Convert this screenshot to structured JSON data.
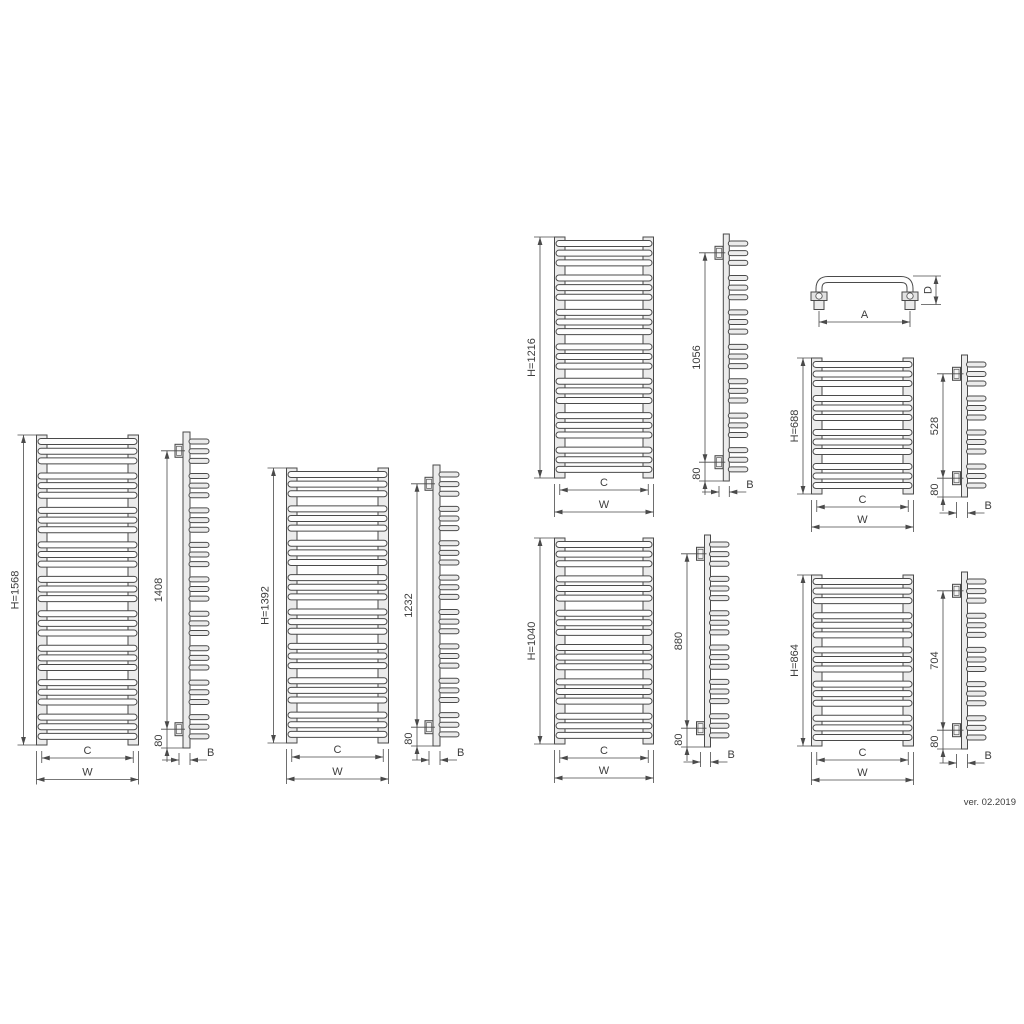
{
  "drawing": {
    "version_label": "ver. 02.2019",
    "handle_detail": {
      "width_label": "A",
      "depth_label": "D"
    },
    "radiators": [
      {
        "height_label": "H=1568",
        "bracket_span_label": "1408",
        "bottom_offset_label": "80",
        "center_dim_label": "C",
        "overall_width_label": "W",
        "depth_dim_label": "B",
        "tube_groups": 9,
        "tubes_per_group": 3
      },
      {
        "height_label": "H=1392",
        "bracket_span_label": "1232",
        "bottom_offset_label": "80",
        "center_dim_label": "C",
        "overall_width_label": "W",
        "depth_dim_label": "B",
        "tube_groups": 8,
        "tubes_per_group": 3
      },
      {
        "height_label": "H=1216",
        "bracket_span_label": "1056",
        "bottom_offset_label": "80",
        "center_dim_label": "C",
        "overall_width_label": "W",
        "depth_dim_label": "B",
        "tube_groups": 7,
        "tubes_per_group": 3
      },
      {
        "height_label": "H=1040",
        "bracket_span_label": "880",
        "bottom_offset_label": "80",
        "center_dim_label": "C",
        "overall_width_label": "W",
        "depth_dim_label": "B",
        "tube_groups": 6,
        "tubes_per_group": 3
      },
      {
        "height_label": "H=688",
        "bracket_span_label": "528",
        "bottom_offset_label": "80",
        "center_dim_label": "C",
        "overall_width_label": "W",
        "depth_dim_label": "B",
        "tube_groups": 4,
        "tubes_per_group": 3
      },
      {
        "height_label": "H=864",
        "bracket_span_label": "704",
        "bottom_offset_label": "80",
        "center_dim_label": "C",
        "overall_width_label": "W",
        "depth_dim_label": "B",
        "tube_groups": 5,
        "tubes_per_group": 3
      }
    ],
    "colors": {
      "line": "#4a4a4a",
      "fill_light": "#ebebeb",
      "fill_bracket": "#e2e2e2",
      "fill_bracket_inner": "#f5f5f5",
      "fill_tube_front": "#fdfdfd",
      "text": "#3d3d3d"
    }
  }
}
